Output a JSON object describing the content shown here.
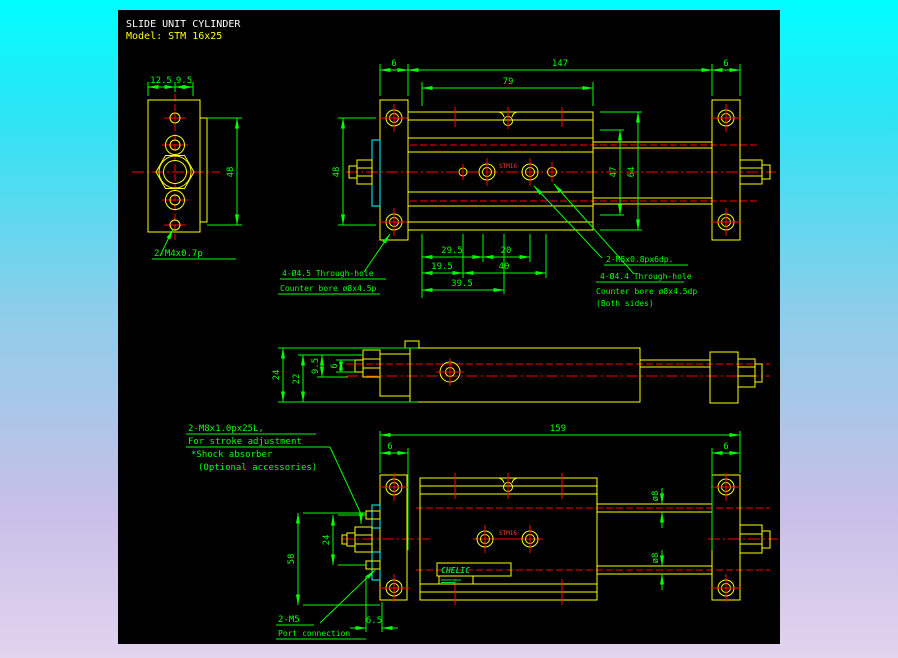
{
  "colors": {
    "geometry": "#ffff00",
    "dimension": "#00ff00",
    "centerline": "#ff0000",
    "hatch": "#00ffff",
    "canvas": "#000000",
    "title": "#ffffff",
    "model": "#ffff00"
  },
  "title": {
    "product": "SLIDE UNIT CYLINDER",
    "model": "Model: STM 16x25"
  },
  "end_view": {
    "dim_width_left": "12.5",
    "dim_width_right": "9.5",
    "dim_height": "48",
    "thread_label": "2-M4x0.7p"
  },
  "top_view": {
    "dim_plate_left": "6",
    "dim_total": "147",
    "dim_plate_right": "6",
    "dim_body": "79",
    "dim_height": "48",
    "dim_inner_height": "47",
    "dim_outer_height": "64",
    "dim_a": "29.5",
    "dim_b": "20",
    "dim_c": "19.5",
    "dim_d": "40",
    "dim_e": "39.5",
    "body_mark": "STM16",
    "label_left": [
      "4-Ø4.5 Through-hole",
      "Counter bore ø8x4.5p"
    ],
    "label_thread": "2-M5x0.8px6dp.",
    "label_right": [
      "4-Ø4.4 Through-hole",
      "Counter bore ø8x4.5dp",
      "(Both sides)"
    ]
  },
  "side_view": {
    "dim_height": "24",
    "dim_inner": "22",
    "dim_offset": "9.5",
    "dim_rod": "6"
  },
  "bottom_view": {
    "dim_total": "159",
    "dim_plate_left": "6",
    "dim_plate_right": "6",
    "dim_span": "58",
    "dim_port_pitch": "24",
    "dim_rod_dia_top": "ø8",
    "dim_rod_dia_bottom": "ø8",
    "dim_port_depth": "6.5",
    "body_mark": "STM16",
    "nameplate": "CHELIC",
    "label_adjuster": [
      "2-M8x1.0px25L,",
      "For stroke adjustment",
      "*Shock absorber",
      "(Optional accessories)"
    ],
    "label_port": [
      "2-M5",
      "Port connection"
    ]
  }
}
